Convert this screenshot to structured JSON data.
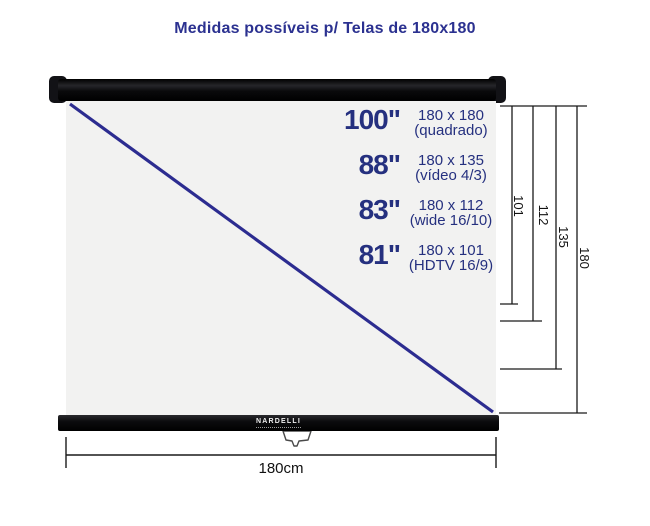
{
  "title": "Medidas possíveis p/ Telas de 180x180",
  "screen": {
    "brand": "NARDELLI",
    "sizes": [
      {
        "inches": "100\"",
        "dimensions": "180 x 180",
        "format": "(quadrado)"
      },
      {
        "inches": "88\"",
        "dimensions": "180 x 135",
        "format": "(vídeo 4/3)"
      },
      {
        "inches": "83\"",
        "dimensions": "180 x 112",
        "format": "(wide 16/10)"
      },
      {
        "inches": "81\"",
        "dimensions": "180 x 101",
        "format": "(HDTV 16/9)"
      }
    ]
  },
  "dimensions": {
    "vertical_cm": [
      "101",
      "112",
      "135",
      "180"
    ],
    "horizontal_width": "180cm"
  },
  "colors": {
    "text_navy": "#25307f",
    "title_navy": "#2b3190",
    "diagonal_navy": "#2c2c90",
    "dimension_line": "#1a1a1a",
    "screen_surface": "#f2f2f1",
    "casing_black": "#0c0c0e"
  }
}
